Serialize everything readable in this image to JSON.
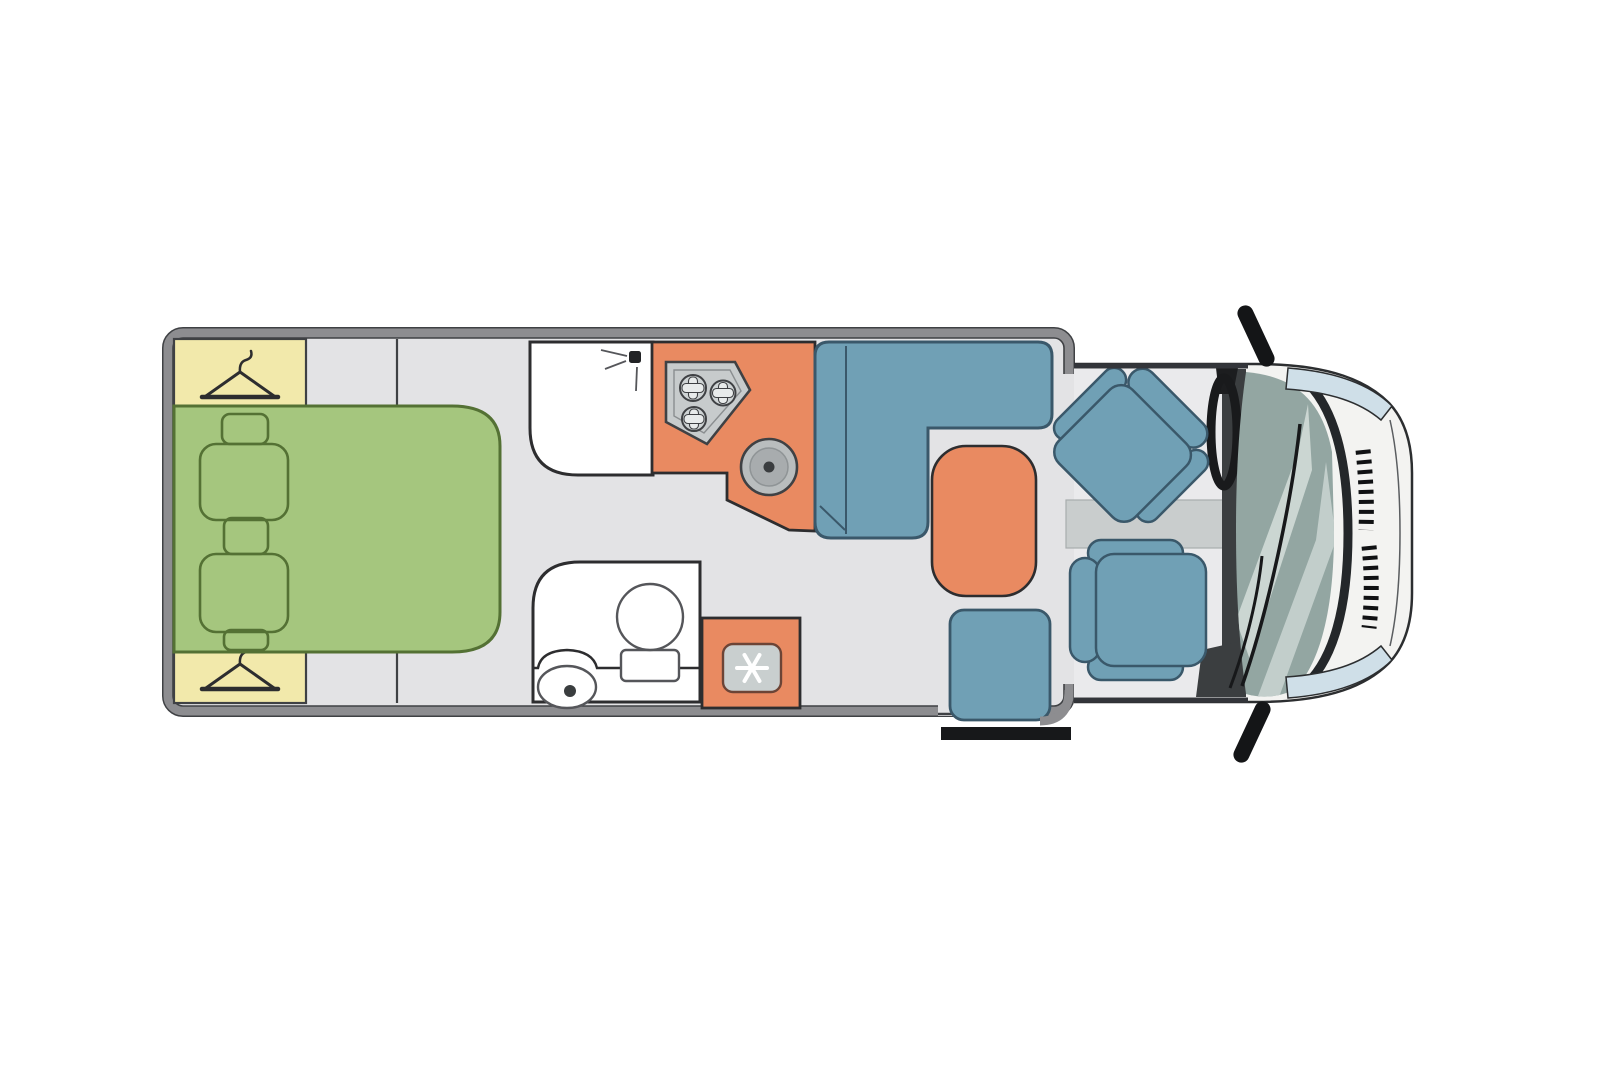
{
  "diagram": {
    "type": "motorhome-floorplan-top-view",
    "orientation": "cab-on-right",
    "regions": [
      "bedroom",
      "wardrobe-top",
      "wardrobe-bottom",
      "double-bed",
      "shower-room",
      "kitchen-counter",
      "toilet-room",
      "fridge",
      "l-shaped-dinette-sofa",
      "dinette-table",
      "side-seat",
      "entry-step",
      "cab",
      "driver-seat",
      "passenger-seat"
    ],
    "icons": [
      "clothes-hanger-icon",
      "shower-head-icon",
      "hob-burners-icon",
      "round-sink-icon",
      "toilet-icon",
      "washbasin-icon",
      "snowflake-icon",
      "steering-wheel-icon",
      "mirror-icon"
    ]
  },
  "colors": {
    "page_bg": "#ffffff",
    "wall": "#8d8d90",
    "outline": "#3f4144",
    "floor": "#e3e3e5",
    "cab_floor": "#eaeaec",
    "bed": "#a5c67e",
    "bed_line": "#547134",
    "wardrobe": "#f2e9ab",
    "orange": "#e98a61",
    "blue": "#70a0b5",
    "blue_line": "#3a586a",
    "white_room": "#ffffff",
    "appliance": "#c7cbcc",
    "appliance_light": "#e8ebeb",
    "glass": "#93a6a2",
    "glass_light": "#c2cecb",
    "body_white": "#f3f3f1",
    "headlight": "#cfdfe8",
    "black": "#17181a",
    "band": "#c9cdcd",
    "dash_dark": "#3b3e40",
    "room_line": "#2d2d2f"
  }
}
